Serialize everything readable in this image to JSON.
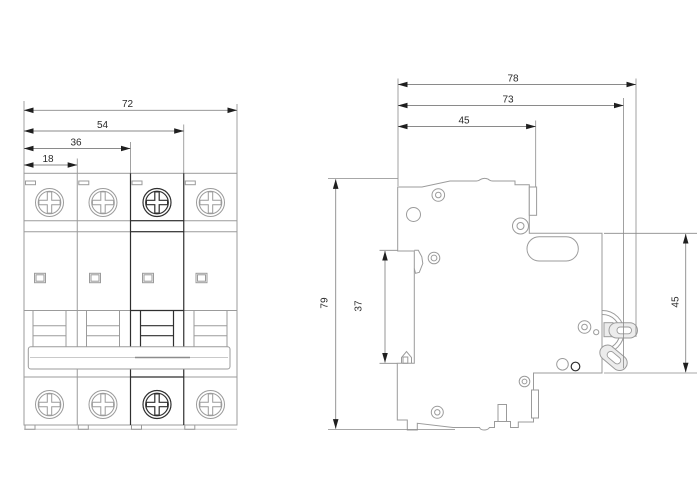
{
  "dimensions_mm": {
    "front": {
      "total_width": "72",
      "three_pole": "54",
      "two_pole": "36",
      "one_pole": "18"
    },
    "side": {
      "total_depth": "78",
      "depth_to_lug": "73",
      "upper_depth": "45",
      "height": "79",
      "rail_recess": "37",
      "front_height": "45"
    }
  }
}
